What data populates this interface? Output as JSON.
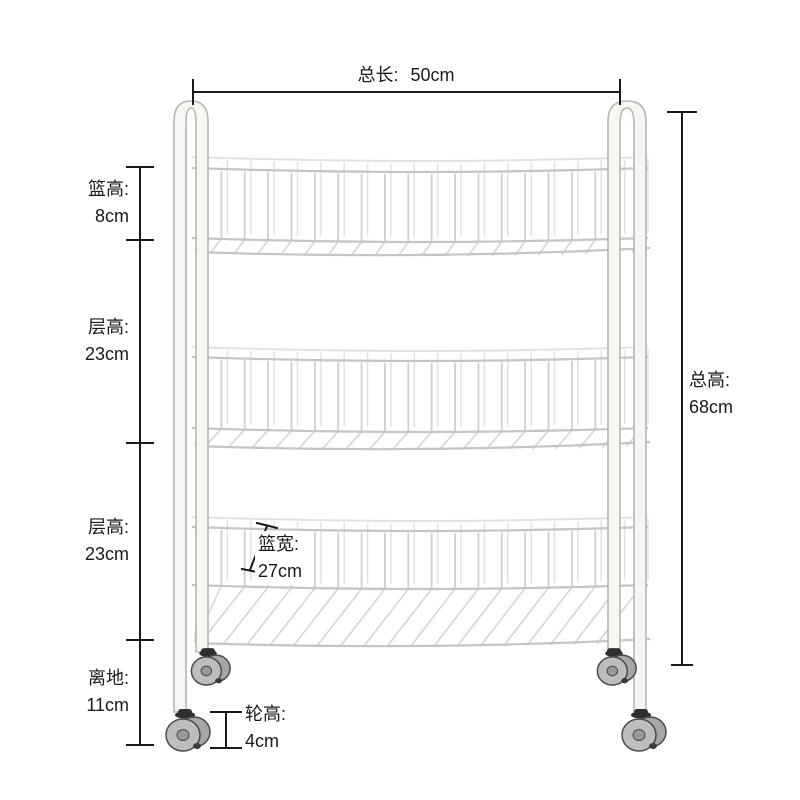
{
  "dimensions": {
    "total_length": {
      "label": "总长:",
      "value": "50cm"
    },
    "basket_height": {
      "label": "篮高:",
      "value": "8cm"
    },
    "tier1_height": {
      "label": "层高:",
      "value": "23cm"
    },
    "tier2_height": {
      "label": "层高:",
      "value": "23cm"
    },
    "ground_clearance": {
      "label": "离地:",
      "value": "11cm"
    },
    "total_height": {
      "label": "总高:",
      "value": "68cm"
    },
    "basket_depth": {
      "label": "篮宽:",
      "value": "27cm"
    },
    "wheel_height": {
      "label": "轮高:",
      "value": "4cm"
    }
  },
  "colors": {
    "dim_line": "#1a1a1a",
    "wire": "#cfcfcf",
    "wire_back": "#e2e2e2",
    "wire_rim": "#c5c5c5",
    "wire_floor": "#d6d6d6",
    "frame_fill": "#f7f6f3",
    "frame_stroke": "#b9b6b1",
    "wheel_fill": "#bdbdbd",
    "wheel_dark": "#a6a6a6",
    "wheel_hub": "#989898",
    "wheel_stroke": "#4a4a4a",
    "caster_collar": "#2f2f2f"
  }
}
